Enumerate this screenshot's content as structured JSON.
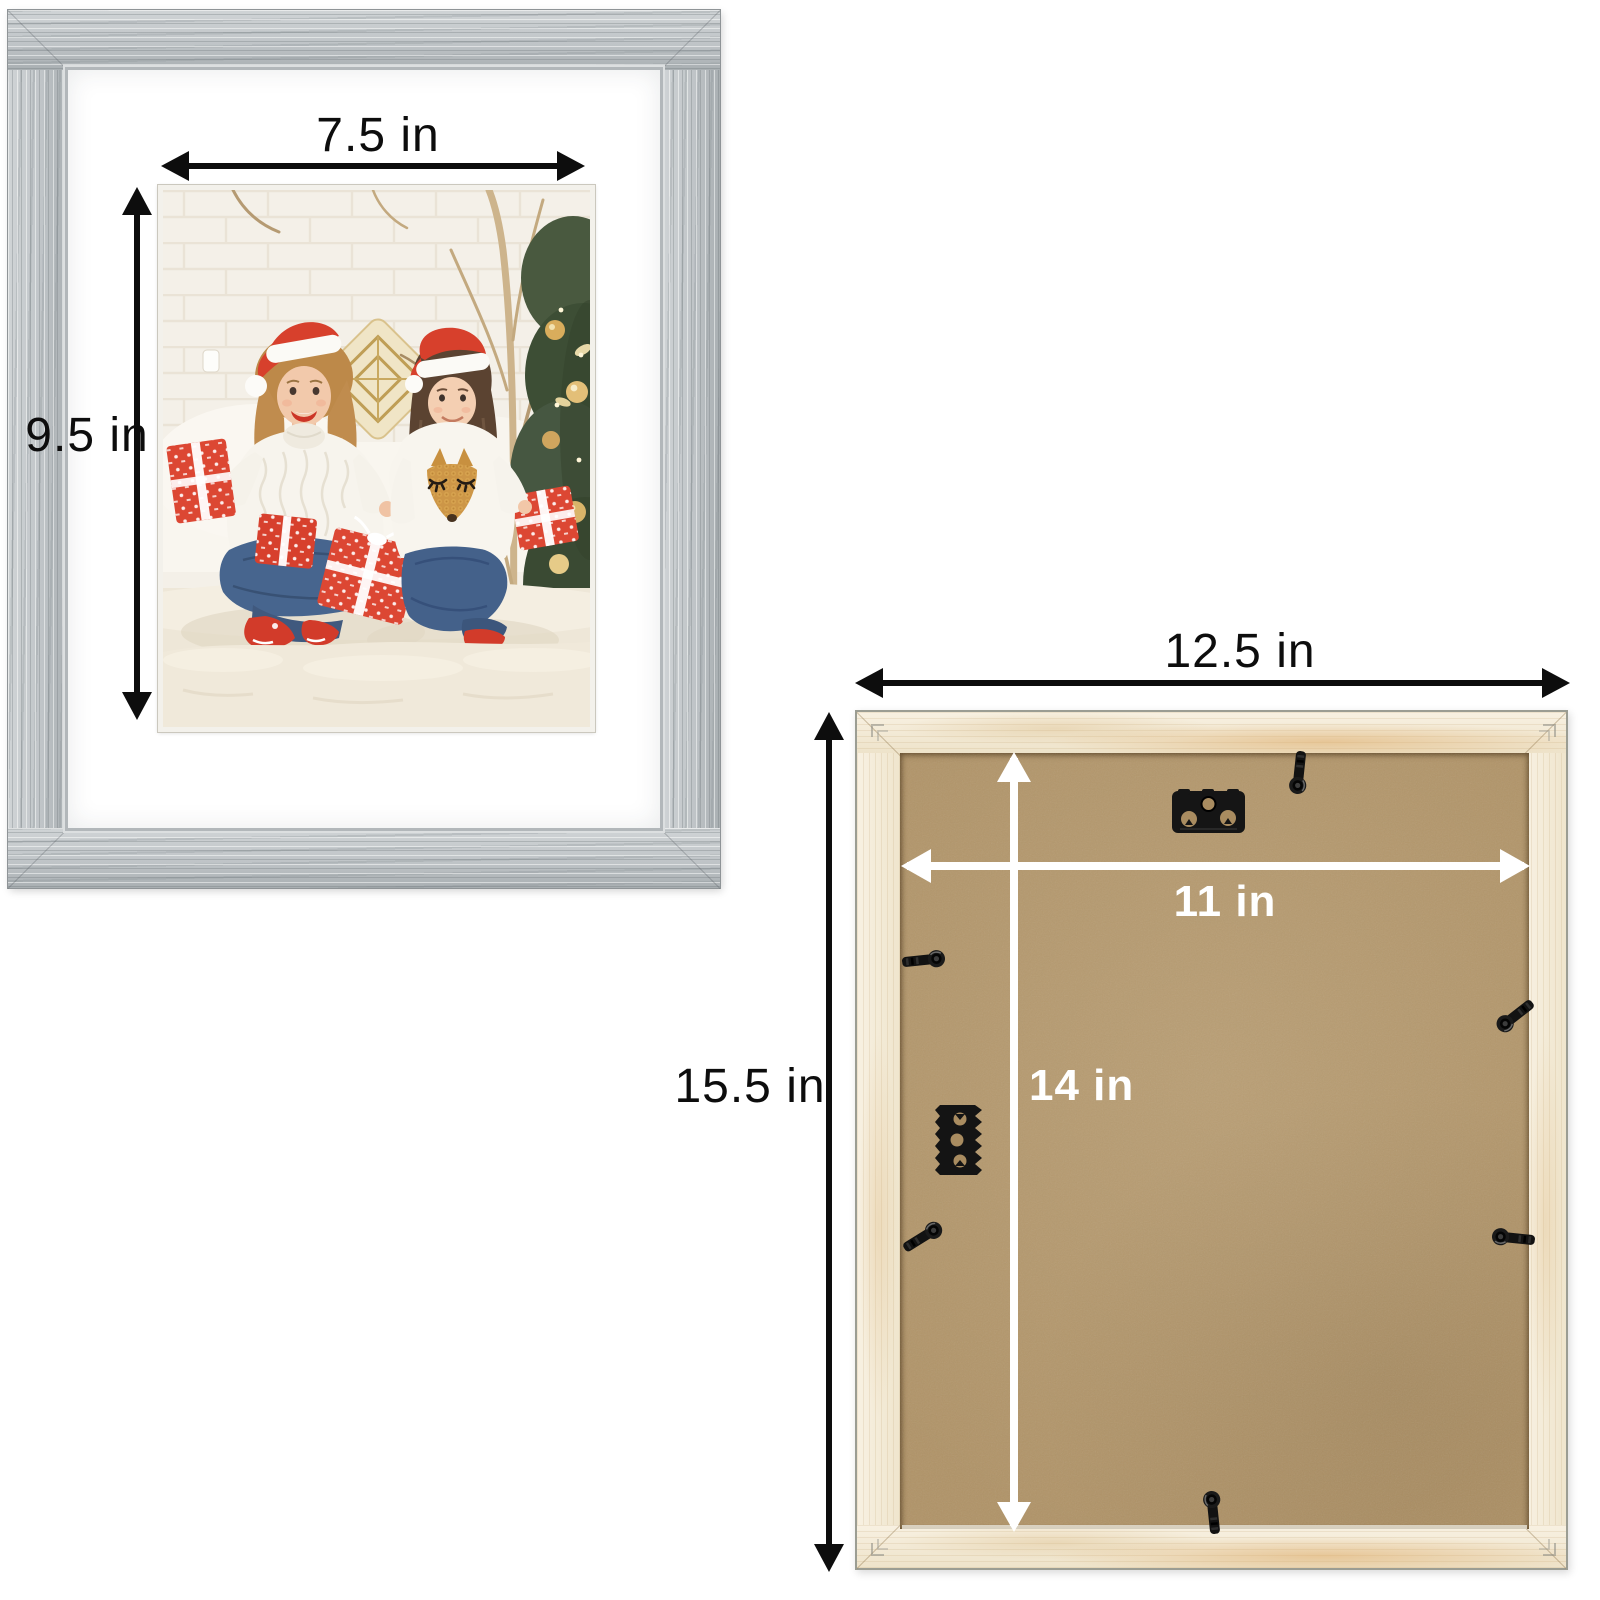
{
  "page": {
    "background_color": "#ffffff"
  },
  "front_frame": {
    "width_label": "7.5 in",
    "height_label": "9.5 in",
    "frame_color": "#c4c8ca",
    "mat_color": "#ffffff",
    "photo_description": "Mother and daughter wearing Santa hats and white knit sweaters, sitting on a white rug with red gift boxes in front of a Christmas tree"
  },
  "back_frame": {
    "outer_width_label": "12.5 in",
    "outer_height_label": "15.5 in",
    "board_width_label": "11 in",
    "board_height_label": "14 in",
    "wood_color": "#f3ebd9",
    "board_color": "#b09367",
    "hardware_icons": [
      "sawtooth-hanger-plate-icon",
      "sawtooth-hanger-side-icon",
      "turn-clip-icon",
      "v-nail-icon"
    ]
  },
  "annotation": {
    "dark_arrow_color": "#0d0d0d",
    "light_arrow_color": "#ffffff"
  }
}
